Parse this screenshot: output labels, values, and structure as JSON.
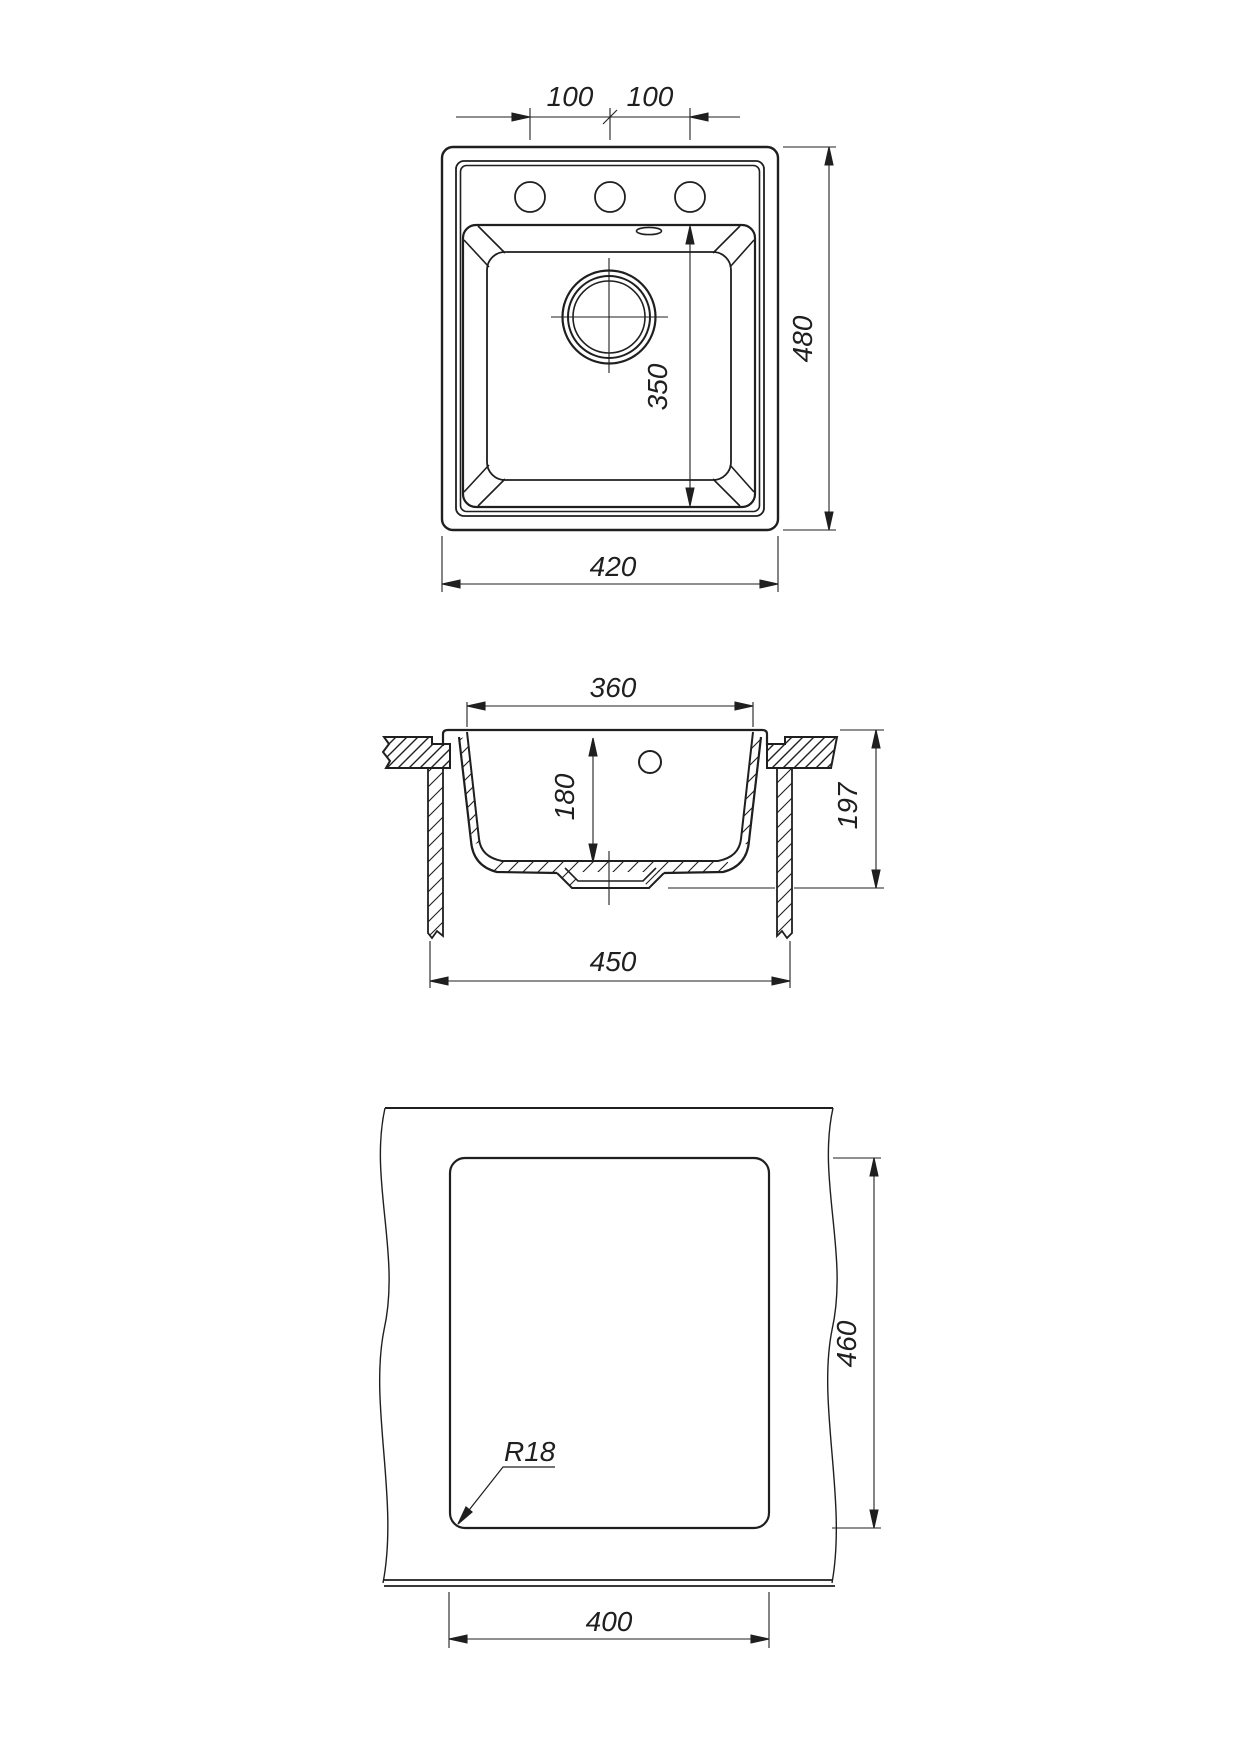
{
  "title": "Kitchen sink installation drawing",
  "colors": {
    "line": "#1f1f1f",
    "bg": "#ffffff"
  },
  "views": {
    "top": {
      "dims": {
        "hole_pitch_left": "100",
        "hole_pitch_right": "100",
        "overall_depth": "480",
        "bowl_length": "350",
        "overall_width": "420"
      }
    },
    "section": {
      "dims": {
        "bowl_top_width": "360",
        "bowl_inner_depth": "180",
        "overall_height": "197",
        "base_width": "450"
      }
    },
    "cutout": {
      "dims": {
        "corner_radius": "R18",
        "cutout_depth": "460",
        "cutout_width": "400"
      }
    }
  }
}
